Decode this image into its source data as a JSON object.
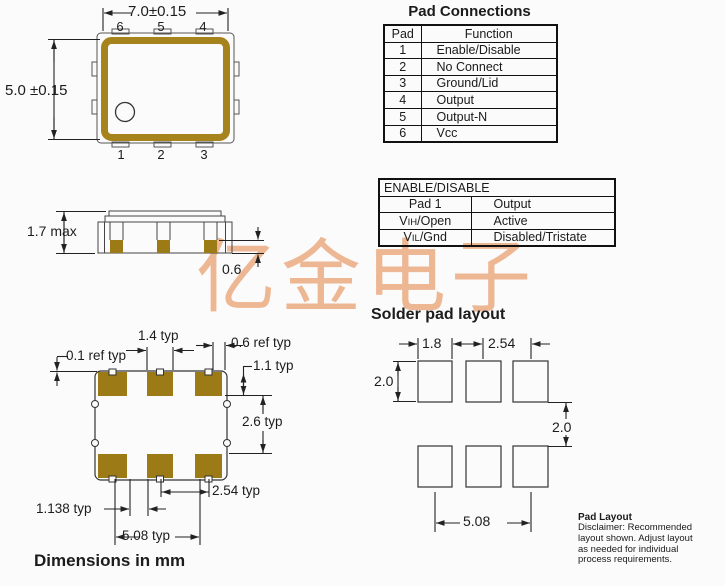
{
  "watermark": {
    "text": "亿金电子",
    "color": "#ecb28b"
  },
  "colors": {
    "gold_border": "#a6831d",
    "gold_pad": "#9c7a15",
    "line": "#222222",
    "background": "#fbfbfb"
  },
  "top_view": {
    "width_dim": "7.0±0.15",
    "height_dim": "5.0 ±0.15",
    "pins_top": [
      "6",
      "5",
      "4"
    ],
    "pins_bottom": [
      "1",
      "2",
      "3"
    ]
  },
  "pad_connections": {
    "title": "Pad Connections",
    "headers": [
      "Pad",
      "Function"
    ],
    "rows": [
      [
        "1",
        "Enable/Disable"
      ],
      [
        "2",
        "No Connect"
      ],
      [
        "3",
        "Ground/Lid"
      ],
      [
        "4",
        "Output"
      ],
      [
        "5",
        "Output-N"
      ],
      [
        "6",
        "Vcc"
      ]
    ]
  },
  "enable_table": {
    "title": "ENABLE/DISABLE",
    "header": {
      "col1": "Pad 1",
      "col2": "Output"
    },
    "rows": [
      {
        "pin": {
          "base": "V",
          "sub": "IH",
          "rest": "/Open"
        },
        "state": "Active"
      },
      {
        "pin": {
          "base": "V",
          "sub": "IL",
          "rest": "/Gnd"
        },
        "state": "Disabled/Tristate"
      }
    ]
  },
  "side_view": {
    "height_dim": "1.7 max",
    "pad_dim": "0.6"
  },
  "land_pattern": {
    "dims": {
      "pad_width": "1.4 typ",
      "notch": "0.6 ref typ",
      "edge_offset": "0.1 ref typ",
      "pad_height": "1.1 typ",
      "row_gap": "2.6 typ",
      "pitch": "2.54 typ",
      "offset": "1.138 typ",
      "span": "5.08 typ"
    },
    "caption": "Dimensions in mm"
  },
  "solder_layout": {
    "title": "Solder pad layout",
    "dims": {
      "pad_width": "1.8",
      "pitch": "2.54",
      "pad_height": "2.0",
      "row_gap": "2.0",
      "span": "5.08"
    },
    "note_title": "Pad Layout",
    "note_lines": [
      "Disclaimer: Recommended",
      "layout shown. Adjust layout",
      "as needed for individual",
      "process requirements."
    ]
  }
}
